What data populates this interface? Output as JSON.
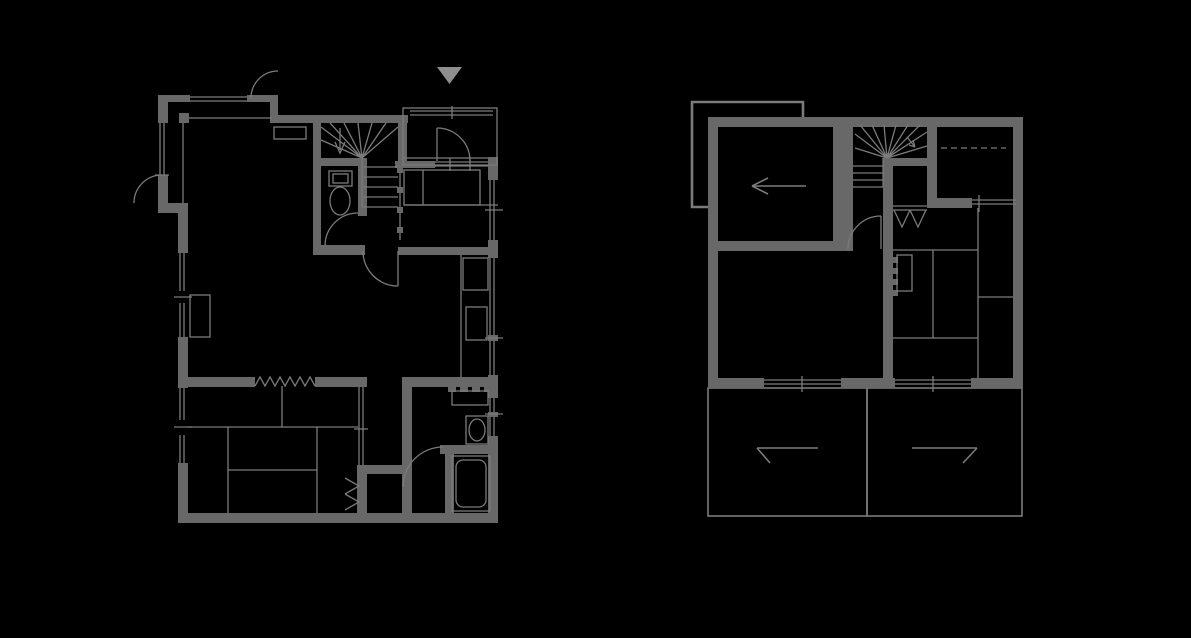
{
  "canvas": {
    "width": 1191,
    "height": 638,
    "background": "#000000"
  },
  "colors": {
    "wall": "#686868",
    "thin_line": "#7b7b7b",
    "entrance_marker": "#8f8f8f"
  },
  "drawing": {
    "type": "architectural-floor-plan",
    "entrance_marker_glyph": "▼",
    "plans": [
      {
        "title": "first-floor-plan",
        "features": [
          "entrance-porch",
          "entrance-sliding-door",
          "entrance-marker-triangle",
          "shoe-cabinet",
          "winder-staircase",
          "stair-handrail",
          "toilet-room",
          "toilet",
          "living-dining-room",
          "kitchen-counter",
          "sink",
          "stove",
          "bedroom",
          "tatami-grid",
          "curtain-partition",
          "closet-folding-doors",
          "sliding-door",
          "washroom",
          "washbasin-counter",
          "washbasin",
          "bathroom",
          "bathtub",
          "hinged-doors",
          "windows"
        ]
      },
      {
        "title": "second-floor-plan",
        "features": [
          "lower-roof-outline",
          "direction-arrow-room",
          "winder-staircase",
          "stair-up-arrow",
          "closet-folding-doors",
          "tatami-room",
          "desk",
          "sliding-window-partition",
          "dashed-ceiling-line",
          "hinged-door",
          "windows",
          "balcony-left",
          "balcony-right",
          "roof-slope-marks"
        ]
      }
    ]
  }
}
